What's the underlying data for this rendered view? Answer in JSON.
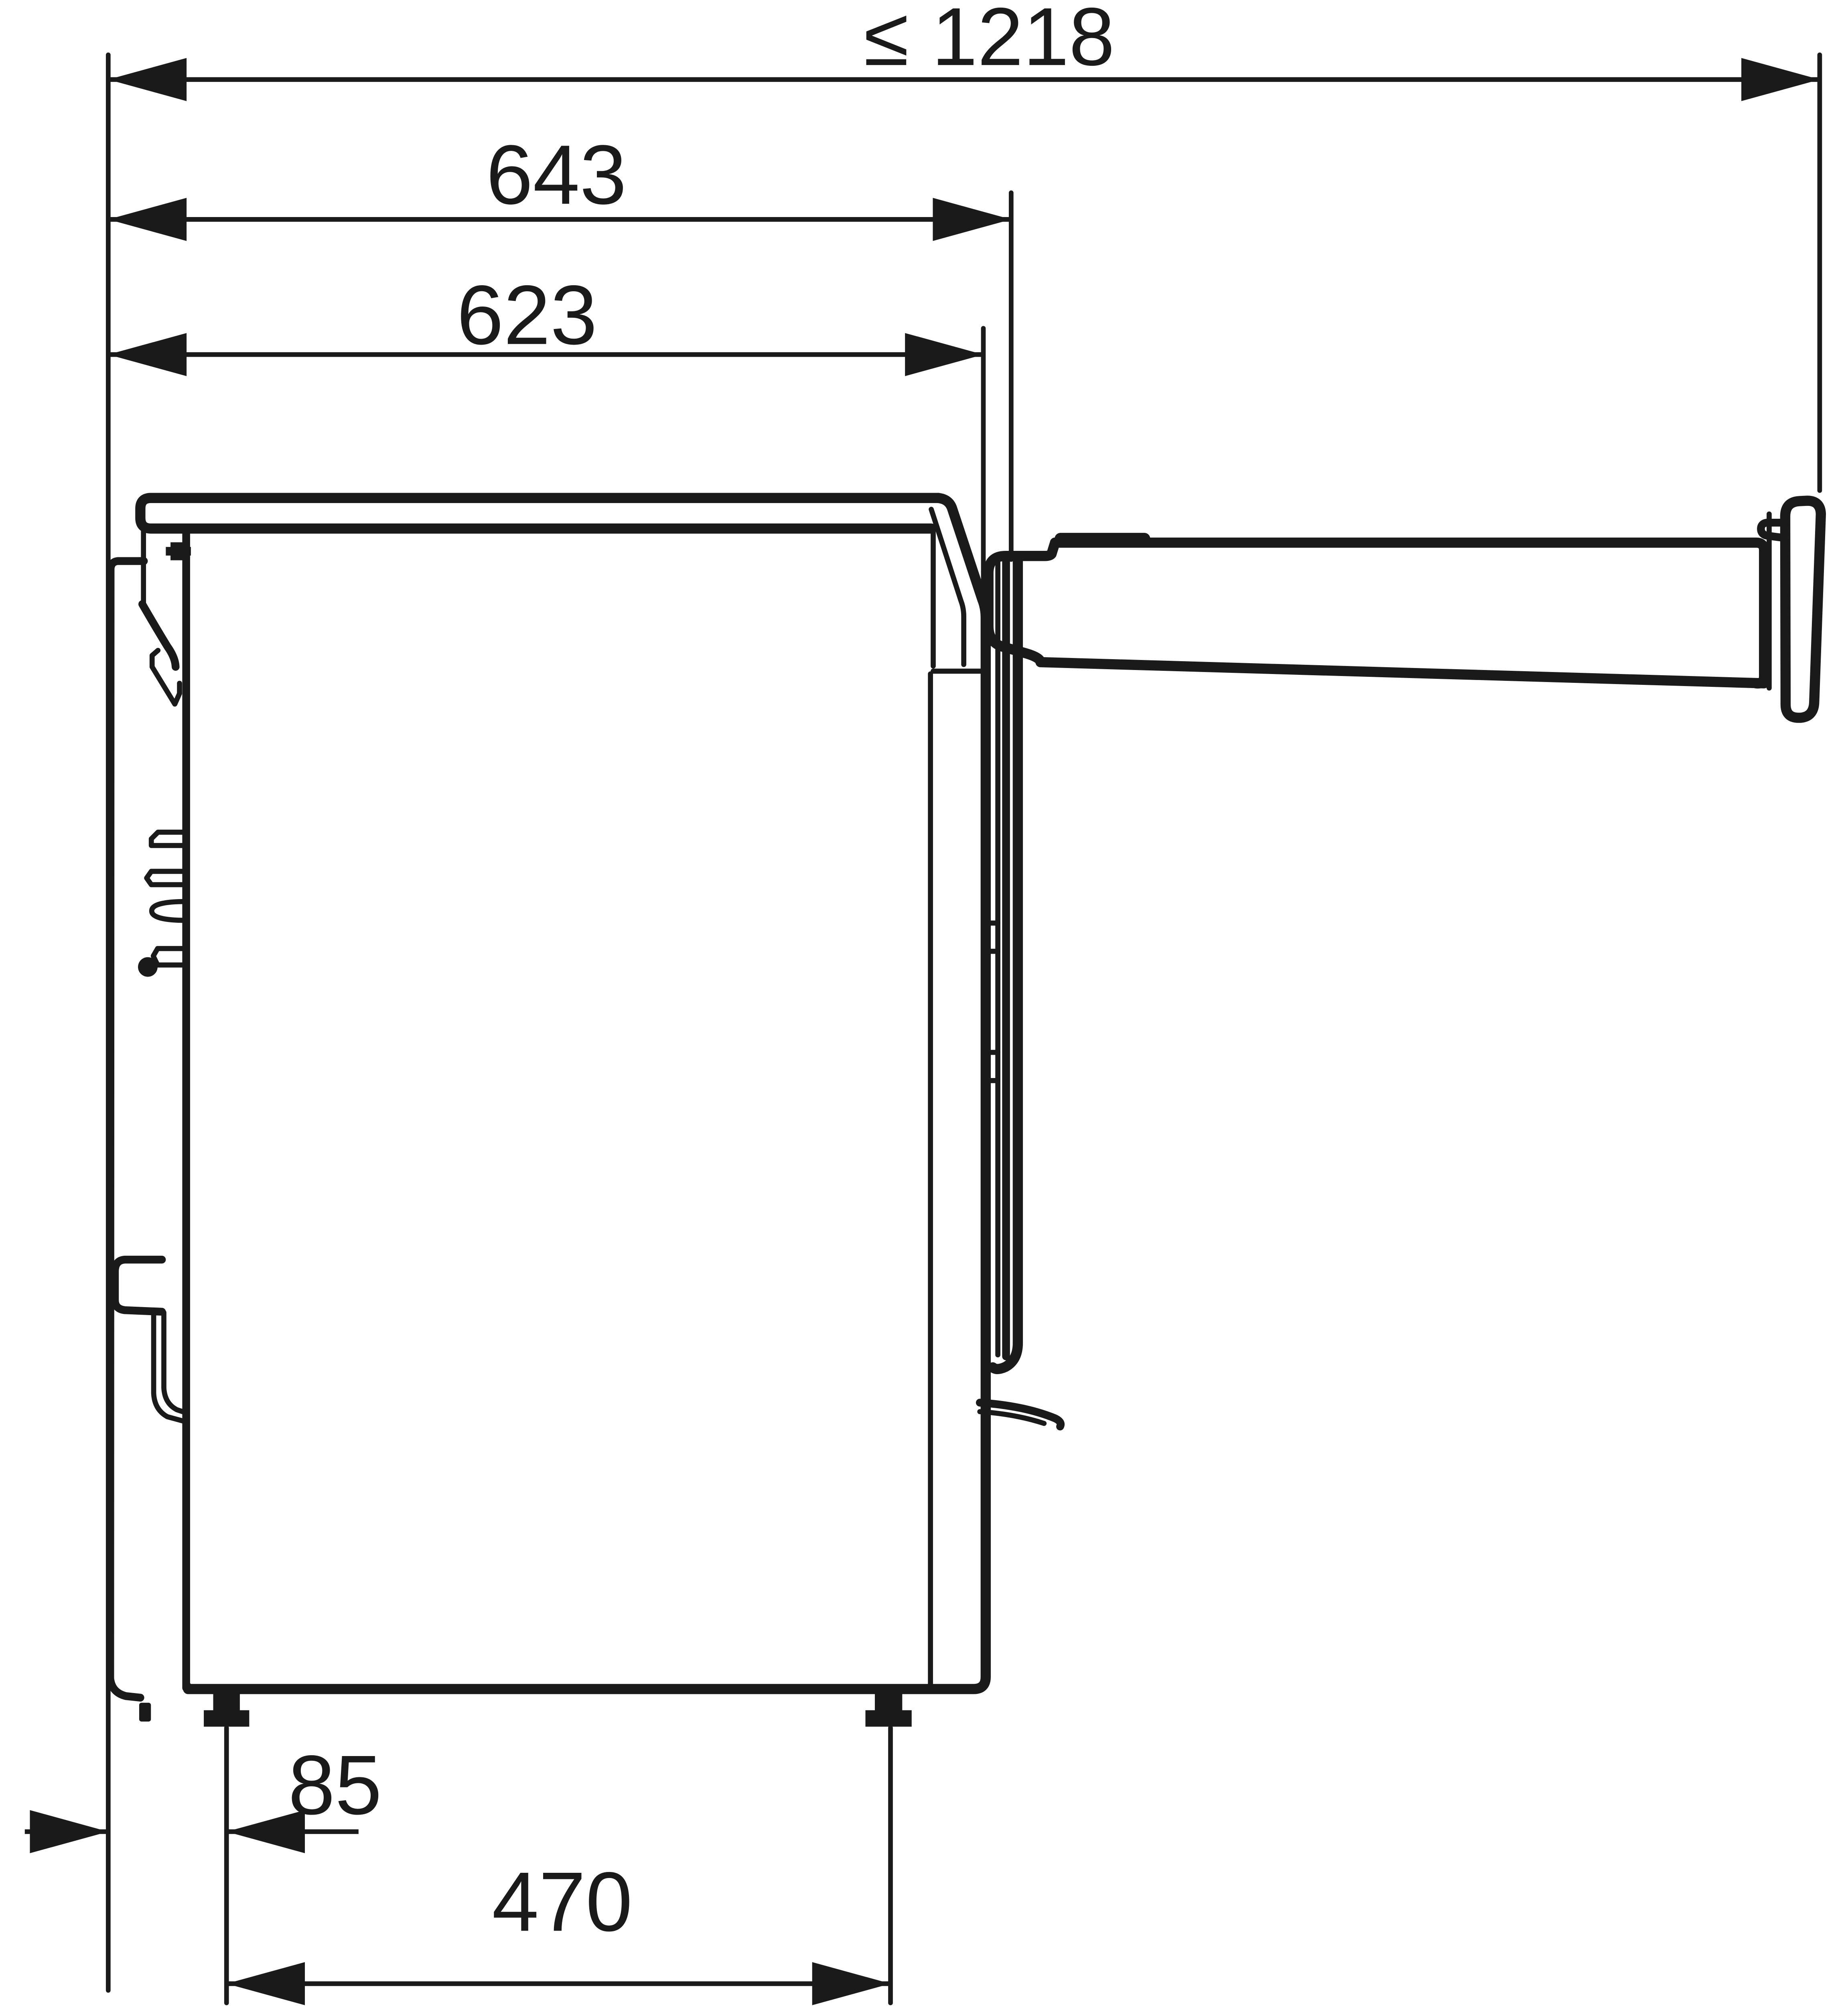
{
  "figure": {
    "background": "#ffffff",
    "ink": "#1a1a1a"
  },
  "dimensions": {
    "total_depth_door_open": {
      "label": "≤ 1218"
    },
    "depth_to_door_front": {
      "label": "643"
    },
    "body_depth": {
      "label": "623"
    },
    "rear_foot_offset": {
      "label": "85"
    },
    "foot_spacing": {
      "label": "470"
    }
  }
}
